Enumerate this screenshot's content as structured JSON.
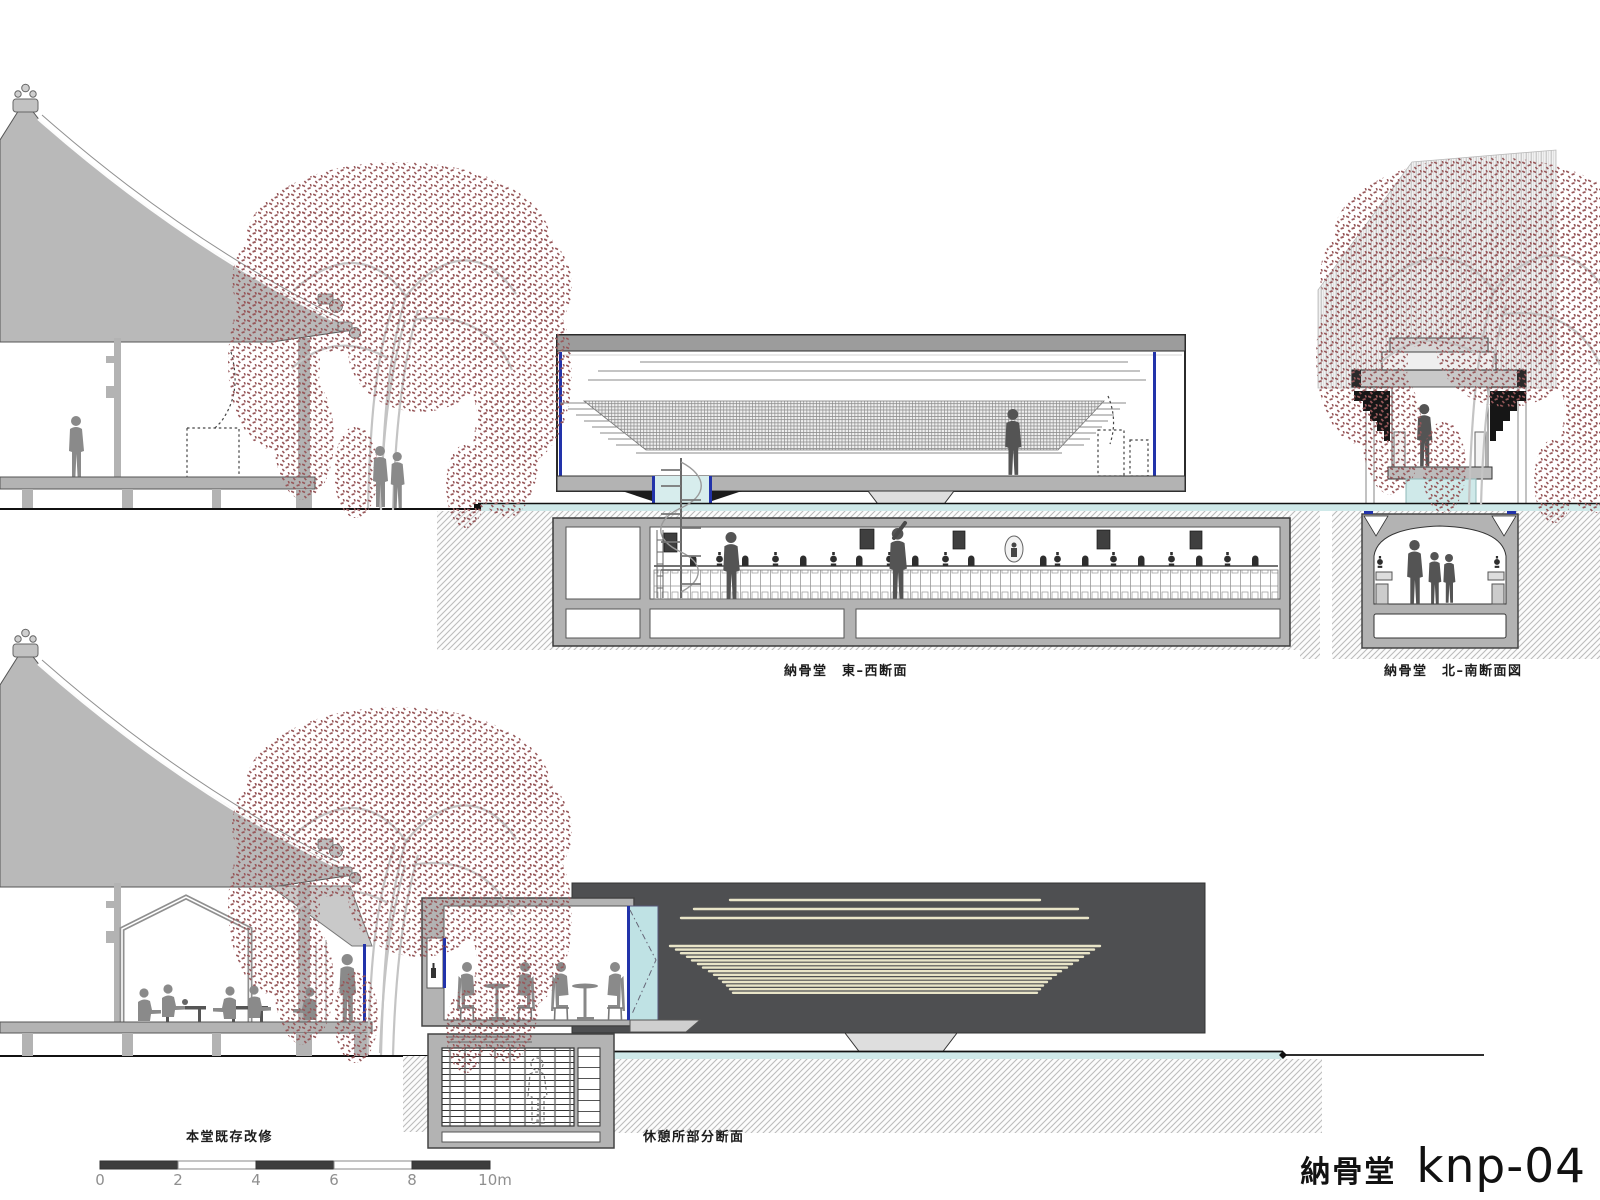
{
  "sheet": {
    "project": "納骨堂",
    "sheet_number": "knp-04"
  },
  "captions": {
    "east_west": "納骨堂　東–西断面",
    "north_south": "納骨堂　北–南断面図",
    "main_hall": "本堂既存改修",
    "rest_area": "休憩所部分断面"
  },
  "scale_bar": {
    "unit": "m",
    "ticks": [
      "0",
      "2",
      "4",
      "6",
      "8",
      "10m"
    ]
  },
  "colors": {
    "roof_gray": "#b9b9b9",
    "wall_gray": "#b3b3b3",
    "figure_gray": "#8a8a8a",
    "figure_dark": "#545454",
    "foliage_red": "#97585a",
    "branch_gray": "#c4c4c4",
    "water_cyan": "#cfe9e9",
    "glass_cyan": "#bfe2e4",
    "accent_blue": "#2233aa",
    "dark_panel": "#4e4f51",
    "louver_cream": "#e9e5c8",
    "hatch_gray": "#bcbcbc",
    "label_gray": "#8f8f8f",
    "scale_dark": "#3d3d3d"
  }
}
